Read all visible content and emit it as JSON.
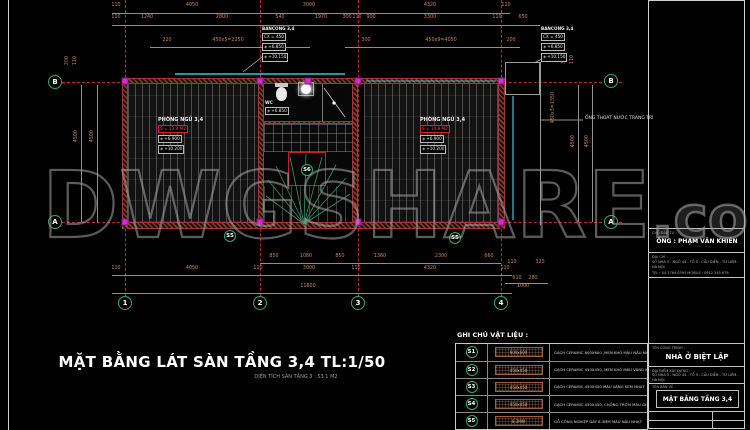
{
  "colors": {
    "background": "#000000",
    "dim_text": "#c9855e",
    "grid_line": "#bb2b2b",
    "grid_bubble": "#2fa878",
    "wall": "#7a4526",
    "column": "#d02ed0",
    "pipe": "#35c8d8",
    "red_accent": "#cc2020",
    "watermark_gray": "#a0a0a0"
  },
  "icons": {
    "level_marker": "◈"
  },
  "watermark": {
    "main": "DWGSHARE",
    "suffix": ".com"
  },
  "plan_title": {
    "main": "MẶT BẰNG LÁT SÀN TẦNG 3,4 TL:1/50",
    "sub": "DIỆN TÍCH SÀN TẦNG 3 :  53.1 M2"
  },
  "grid": {
    "cols": [
      "1",
      "2",
      "3",
      "4"
    ],
    "row_top": "B",
    "row_bottom": "A"
  },
  "dims": {
    "top1": [
      "110",
      "4050",
      "3000",
      "4320",
      "110"
    ],
    "top2": [
      "110",
      "1240",
      "2800",
      "540",
      "1970",
      "300",
      "110",
      "900",
      "3300",
      "110",
      "650"
    ],
    "top3": [
      "220",
      "450x5=2250",
      "300",
      "450x9=4050",
      "200"
    ],
    "bottom1": [
      "850",
      "1080",
      "850",
      "1360",
      "2300",
      "660"
    ],
    "bottom2": [
      "110",
      "4050",
      "110",
      "3000",
      "110",
      "4320",
      "110"
    ],
    "cluster": [
      "110",
      "320",
      "610",
      "280",
      "1000"
    ],
    "total": "11600",
    "left": [
      "4500",
      "4500"
    ],
    "left_top": [
      "200",
      "110"
    ],
    "right": [
      "4500",
      "4500"
    ],
    "right_extra": "450x3=1350",
    "right_top": [
      "360",
      "110"
    ]
  },
  "rooms": {
    "left": {
      "name": "PHÒNG NGỦ 3,4",
      "area": "S = 13.9 M2",
      "lv1": "+6.900",
      "lv2": "+10.200"
    },
    "right": {
      "name": "PHÒNG NGỦ 3,4",
      "area": "S = 14.8 M2",
      "lv1": "+6.900",
      "lv2": "+10.200"
    },
    "wc": {
      "name": "WC",
      "lv": "+6.850"
    },
    "tags": {
      "stair": "S6",
      "left_floor": "S5",
      "right_floor": "S5"
    }
  },
  "balcony_center": {
    "name": "BANCONG 3,4",
    "cx": "CX = 450",
    "lv1": "+6.850",
    "lv2": "+10.150"
  },
  "balcony_right": {
    "name": "BANCONG 3,4",
    "cx": "CX = 450",
    "lv1": "+6.850",
    "lv2": "+10.150"
  },
  "notes": {
    "pipe": "ỐNG THOÁT NƯỚC TRANG TRÍ"
  },
  "legend": {
    "title": "GHI CHÚ VẬT LIỆU :",
    "rows": [
      {
        "tag": "S1",
        "swatch": "600x600",
        "desc": "GẠCH CERAMIC 600X600 ,MEN KHÔ MÀU NÂU NHẠT"
      },
      {
        "tag": "S2",
        "swatch": "450x450",
        "desc": "GẠCH CERAMIC 450X450, MEN KHÔ MÀU VÀNG KEM SẪM"
      },
      {
        "tag": "S3",
        "swatch": "450x450",
        "desc": "GẠCH CERAMIC 450X450  MÀU VÀNG KEM NHẠT"
      },
      {
        "tag": "S4",
        "swatch": "450x450",
        "desc": "GẠCH CERAMIC 450X450, CHỐNG TRƠN  MÀU  GHI SÁNG"
      },
      {
        "tag": "S5",
        "swatch": "8.3MM",
        "desc": "GỖ CÔNG NGHIỆP DÀY 8.3MM MÀU NÂU NHẠT"
      }
    ]
  },
  "titleblock": {
    "owner_label": "CHỦ ĐẦU TƯ :",
    "owner": "ÔNG : PHẠM VĂN KHIÊN",
    "addr_label": "ĐỊA CHỈ :",
    "addr": "SỐ NHÀ 5 - NGÕ 44 - TỔ 5 - CẦU DIỄN - TỪ LIÊM - HÀ NỘI",
    "tel": "TEL : 04.3764.0595   MOBILE : 0912.345.678",
    "project_label": "TÊN CÔNG TRÌNH :",
    "project": "NHÀ Ở BIỆT LẬP",
    "site_label": "ĐỊA ĐIỂM XÂY DỰNG :",
    "site": "SỐ NHÀ 5 - NGÕ 44 - TỔ 5 - CẦU DIỄN - TỪ LIÊM - HÀ NỘI",
    "drawing_label": "TÊN BẢN VẼ :",
    "drawing": "MẶT BẰNG TẦNG 3,4"
  }
}
